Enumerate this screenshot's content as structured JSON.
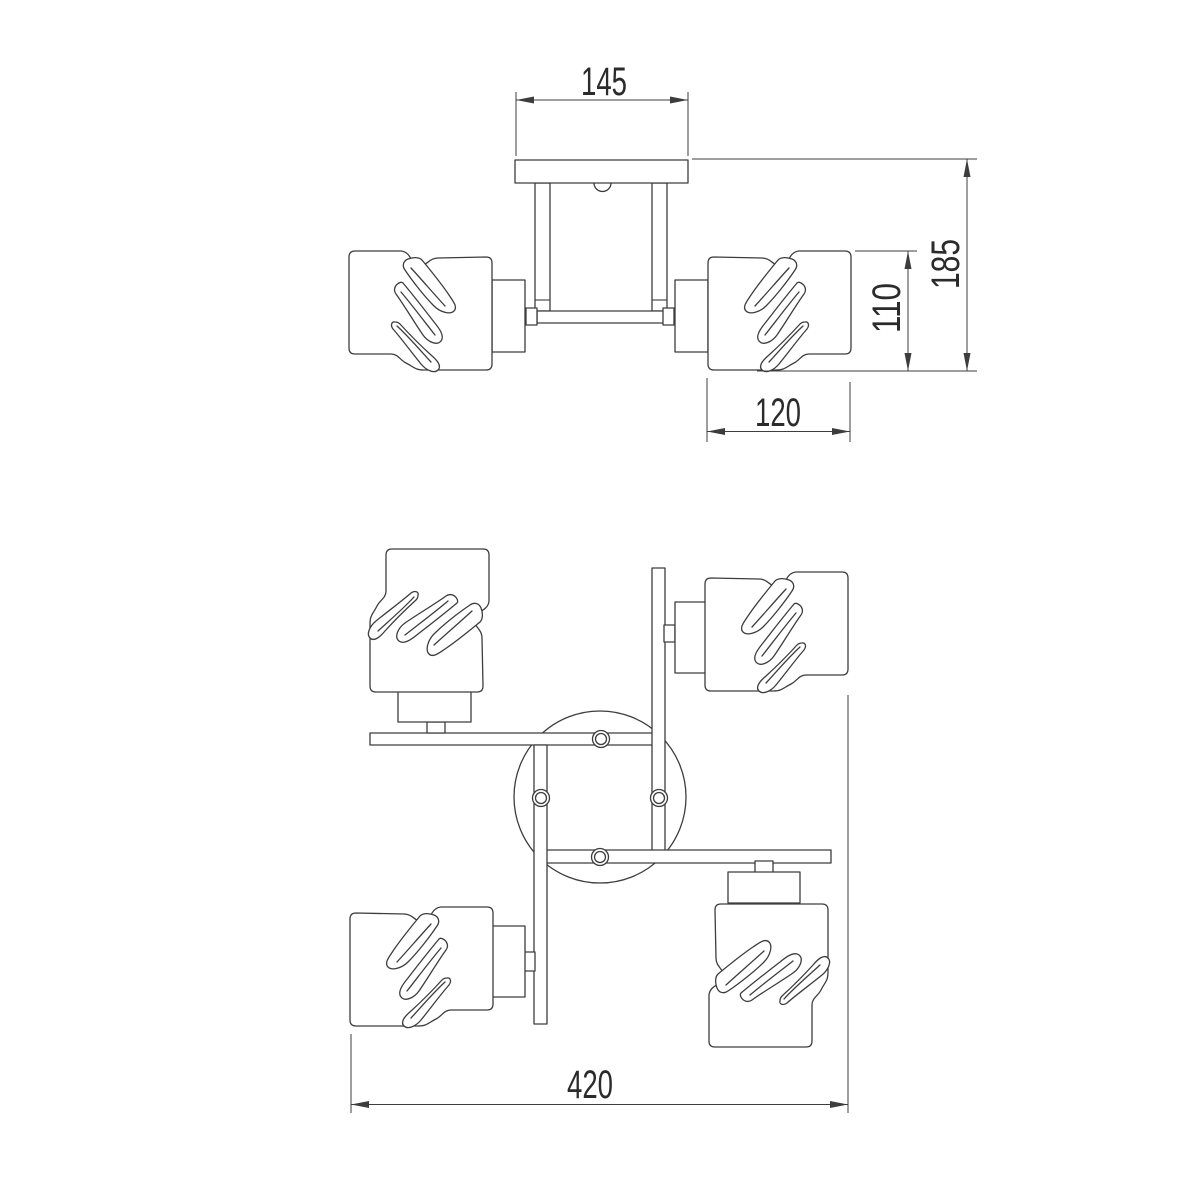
{
  "drawing": {
    "background_color": "#ffffff",
    "line_color": "#3d3d3d",
    "text_color": "#2b2b2b"
  },
  "front_view": {
    "dim_canopy_width": "145",
    "dim_total_height": "185",
    "dim_shade_height": "110",
    "dim_shade_width": "120"
  },
  "top_view": {
    "dim_overall_width": "420"
  }
}
